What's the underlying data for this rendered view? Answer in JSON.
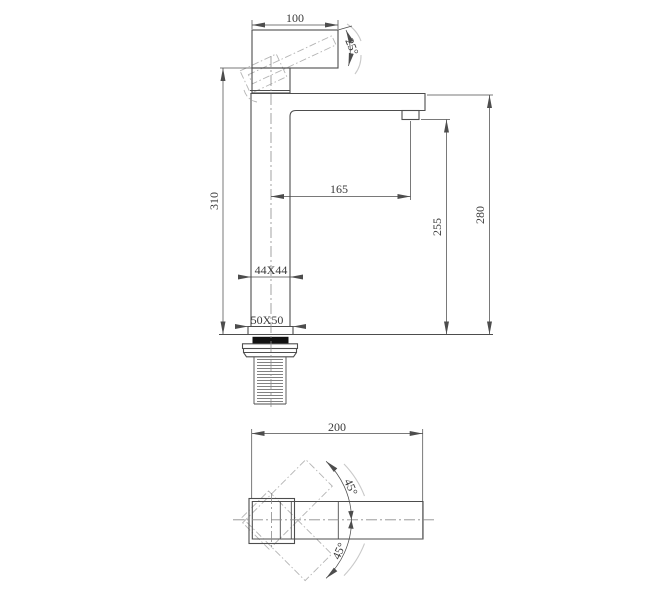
{
  "front_view": {
    "dim_handle_length": "100",
    "dim_handle_angle": "25°",
    "dim_total_height": "310",
    "dim_spout_reach": "165",
    "dim_outlet_height": "255",
    "dim_top_height": "280",
    "dim_body_section": "44X44",
    "dim_base_section": "50X50"
  },
  "top_view": {
    "dim_overall_length": "200",
    "dim_swivel_up": "45°",
    "dim_swivel_down": "45°"
  },
  "colors": {
    "line": "#4d4d4d",
    "phantom": "#b4b4b4",
    "centerline": "#8c8c8c",
    "gasket_fill": "#111111",
    "text": "#3a3a3a",
    "background": "#ffffff"
  }
}
